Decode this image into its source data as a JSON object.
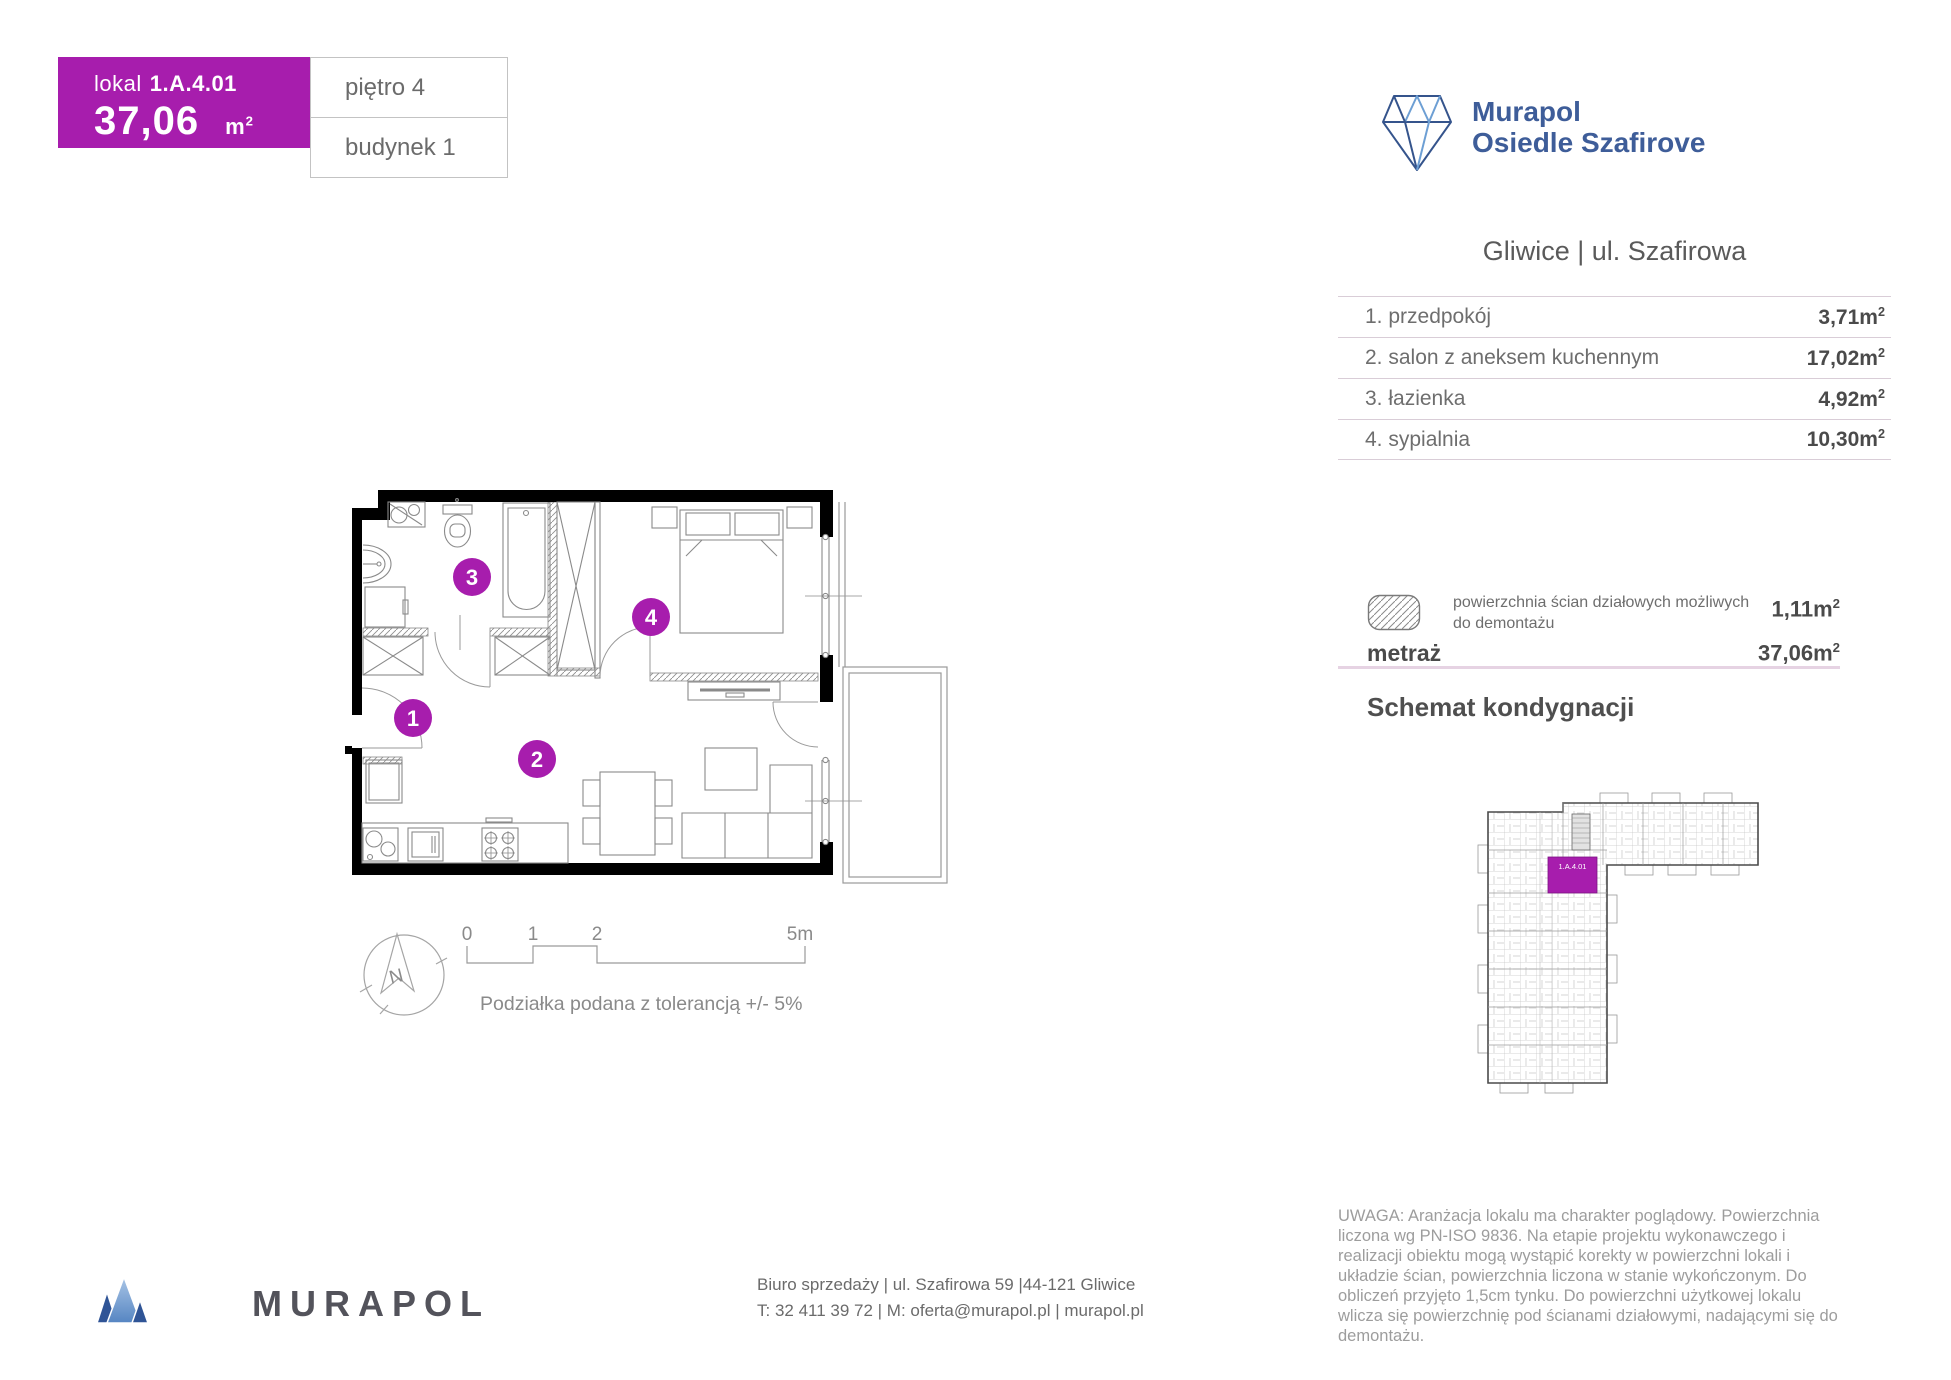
{
  "colors": {
    "purple": "#A71DAD",
    "navy": "#3E5D99",
    "wall_black": "#000000",
    "plan_line": "#8a8a8a",
    "table_line": "#d9cdd7",
    "pink_rule": "#e6d3e3"
  },
  "unit_card": {
    "lokal_label": "lokal",
    "lokal_number": "1.A.4.01",
    "area_value": "37,06",
    "floor": "piętro 4",
    "building": "budynek 1"
  },
  "units": {
    "m": "m",
    "sup": "2"
  },
  "brand": {
    "line1": "Murapol",
    "line2": "Osiedle Szafirove"
  },
  "location": "Gliwice | ul. Szafirowa",
  "rooms": [
    {
      "label": "1. przedpokój",
      "value": "3,71"
    },
    {
      "label": "2. salon z aneksem kuchennym",
      "value": "17,02"
    },
    {
      "label": "3. łazienka",
      "value": "4,92"
    },
    {
      "label": "4. sypialnia",
      "value": "10,30"
    }
  ],
  "summary": {
    "demolition_label": "powierzchnia ścian działowych możliwych do demontażu",
    "demolition_value": "1,11",
    "metraz_label": "metraż",
    "metraz_value": "37,06"
  },
  "floor_schematic": {
    "title": "Schemat kondygnacji",
    "highlight_label": "1.A.4.01"
  },
  "plan": {
    "numbers": [
      "1",
      "2",
      "3",
      "4"
    ],
    "north": "N",
    "scale": {
      "t0": "0",
      "t1": "1",
      "t2": "2",
      "t5": "5m"
    },
    "note": "Podziałka podana z tolerancją +/- 5%"
  },
  "footer": {
    "logo_text": "MURAPOL",
    "address": "Biuro sprzedaży | ul. Szafirowa 59 |44-121 Gliwice",
    "contact": "T: 32 411 39 72 | M: oferta@murapol.pl | murapol.pl"
  },
  "disclaimer": "UWAGA: Aranżacja lokalu ma charakter poglądowy. Powierzchnia liczona wg PN-ISO 9836. Na etapie projektu wykonawczego i realizacji obiektu mogą wystąpić korekty w powierzchni lokali i układzie ścian, powierzchnia liczona w stanie wykończonym. Do obliczeń przyjęto 1,5cm tynku. Do powierzchni użytkowej lokalu wlicza się powierzchnię pod ścianami działowymi, nadającymi się do demontażu."
}
